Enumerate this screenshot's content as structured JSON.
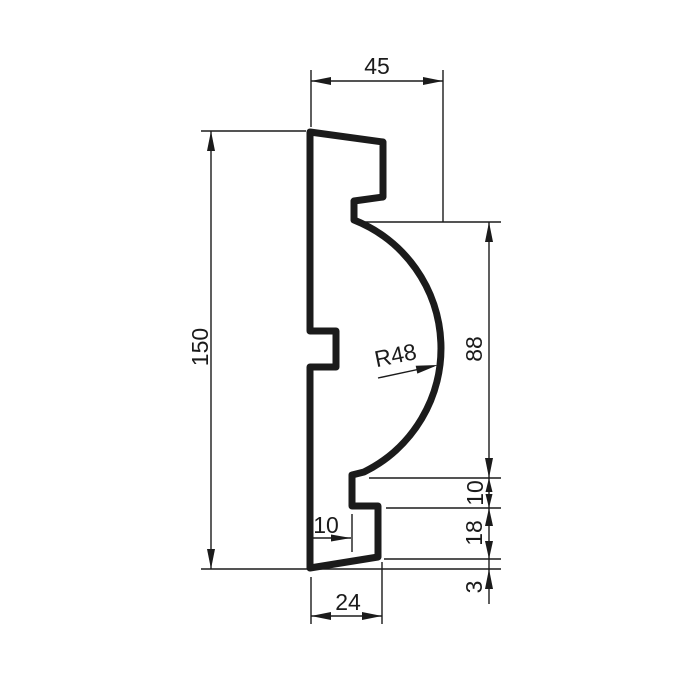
{
  "drawing": {
    "kind": "molding-profile-cross-section",
    "colors": {
      "line": "#1b1b1b",
      "background": "#ffffff"
    },
    "labels": {
      "top_width": "45",
      "overall_height": "150",
      "radius": "R48",
      "curve_height": "88",
      "recess_height": "10",
      "lower_step_height": "18",
      "bottom_bevel": "3",
      "bottom_inset": "10",
      "bottom_depth": "24"
    }
  }
}
